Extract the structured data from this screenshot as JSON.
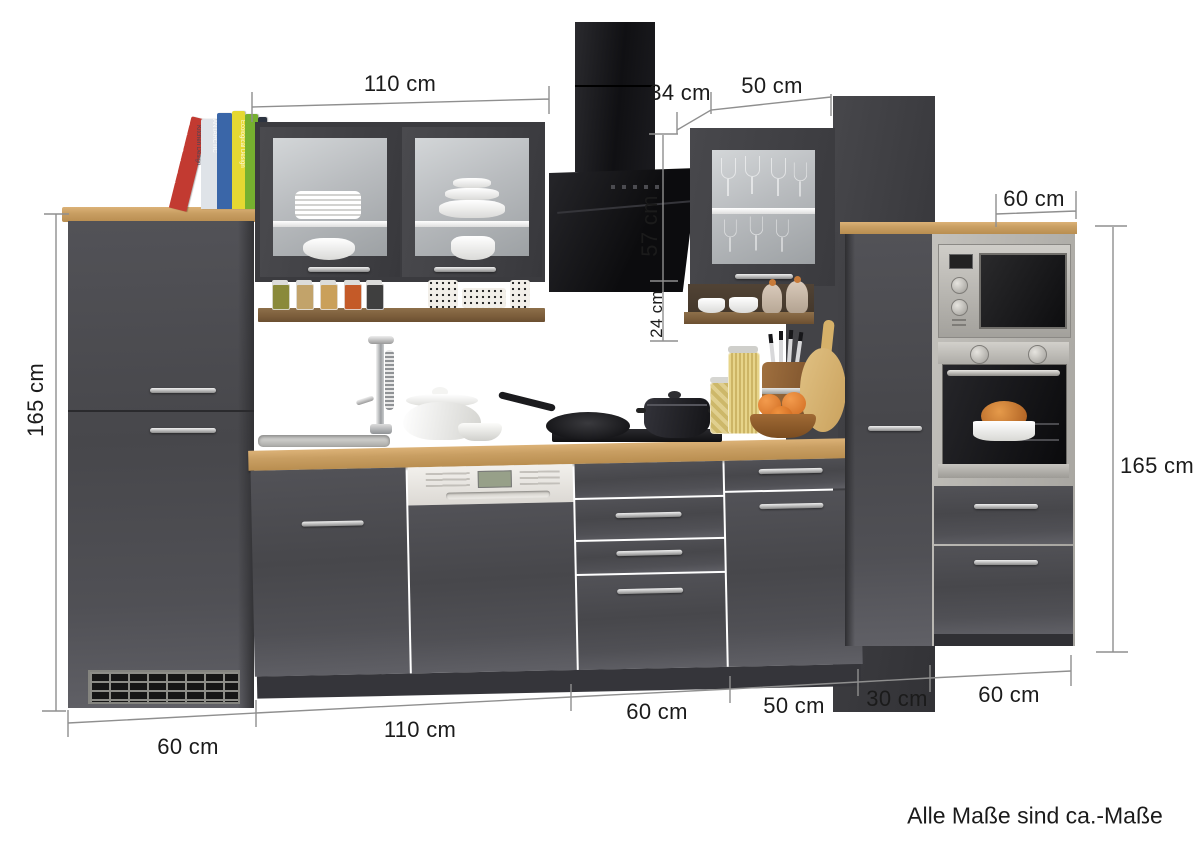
{
  "product": {
    "type": "kitchen-unit-elevation",
    "note": "Alle Maße sind ca.-Maße"
  },
  "annotations": {
    "wall_cabinet_width_top": "110 cm",
    "hood_chimney_depth": "34 cm",
    "glass_cabinet_width_top": "50 cm",
    "hood_height": "57 cm",
    "hood_clearance": "24 cm",
    "tall_unit_width_top": "60 cm",
    "tall_height_left": "165 cm",
    "tall_height_right": "165 cm",
    "bottom_fridge_width": "60 cm",
    "bottom_sink_run_width": "110 cm",
    "bottom_hob_unit_width": "60 cm",
    "bottom_cabinet_width": "50 cm",
    "bottom_narrow_unit_width": "30 cm",
    "bottom_oven_tower_width": "60 cm",
    "note": "Alle Maße sind ca.-Maße"
  },
  "books": [
    {
      "color": "#c23a31",
      "title": "Garden & Outdoor Design"
    },
    {
      "color": "#dfe3e8",
      "title": "Kitchen Design"
    },
    {
      "color": "#3a66a8",
      "title": "ANTARCTIC"
    },
    {
      "color": "#e5d832",
      "title": ""
    },
    {
      "color": "#76b02f",
      "title": "Ecological Design"
    },
    {
      "color": "#2c3340",
      "title": ""
    }
  ],
  "colors": {
    "cabinet_front": "#4b4b4f",
    "cabinet_side": "#39393c",
    "worktop_wood": "#c9a164",
    "shelf_wood": "#7b5d3b",
    "hood_black": "#141416",
    "appliance_steel": "#b7b5b0",
    "dimension_line": "#8f8f8f",
    "dimension_text": "#1b1b1b",
    "background": "#ffffff"
  }
}
